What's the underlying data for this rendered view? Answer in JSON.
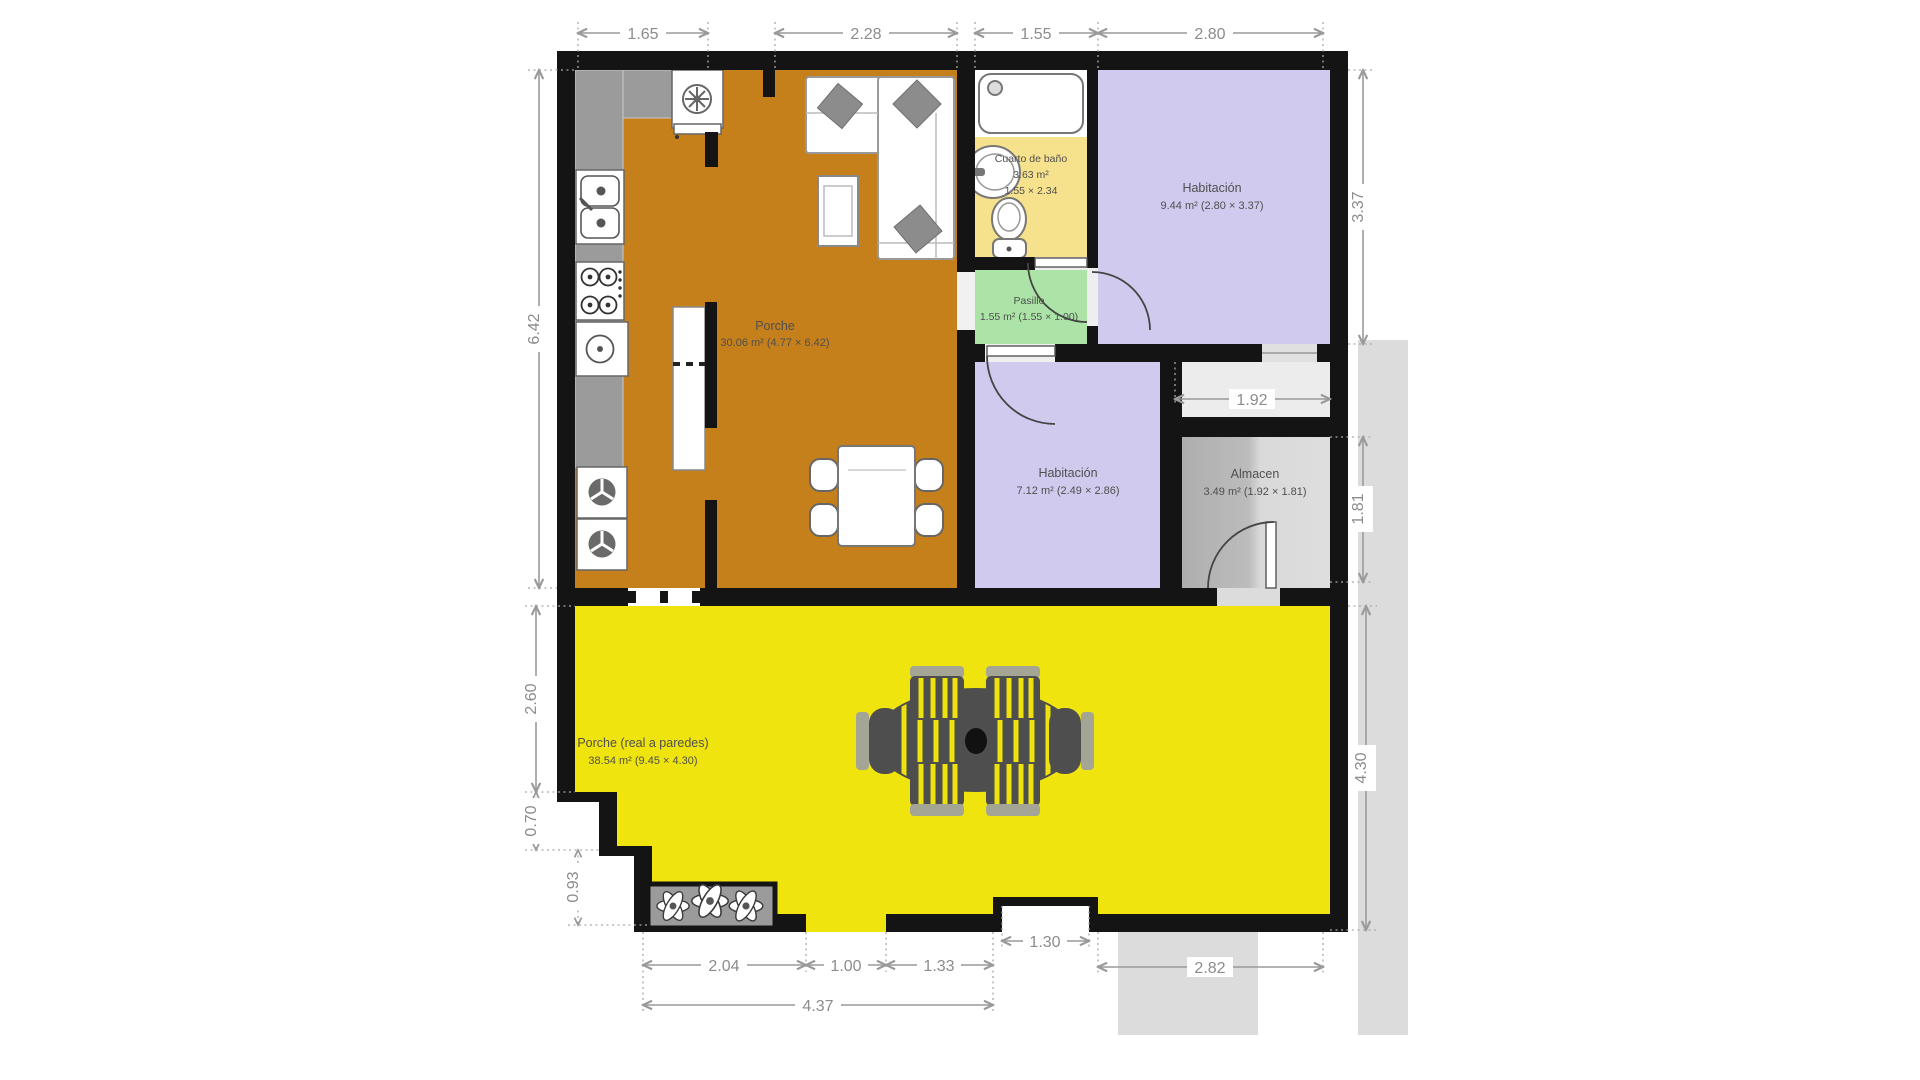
{
  "plan": {
    "title": "floor-plan",
    "rooms": {
      "porche": {
        "name": "Porche",
        "area": "30.06 m² (4.77 × 6.42)"
      },
      "bano": {
        "name": "Cuarto de baño",
        "area": "3.63 m²",
        "size": "1.55 × 2.34"
      },
      "habitacion1": {
        "name": "Habitación",
        "area": "9.44 m² (2.80 × 3.37)"
      },
      "pasillo": {
        "name": "Pasillo",
        "area": "1.55 m² (1.55 × 1.00)"
      },
      "habitacion2": {
        "name": "Habitación",
        "area": "7.12 m² (2.49 × 2.86)"
      },
      "almacen": {
        "name": "Almacen",
        "area": "3.49 m² (1.92 × 1.81)"
      },
      "porche_exterior": {
        "name": "Porche (real a paredes)",
        "area": "38.54 m² (9.45 × 4.30)"
      }
    },
    "dims": {
      "top": [
        "1.65",
        "2.28",
        "1.55",
        "2.80"
      ],
      "left": [
        "6.42",
        "2.60",
        "0.70",
        "0.93"
      ],
      "right": [
        "3.37",
        "1.92",
        "1.81",
        "4.30"
      ],
      "bottom": [
        "2.04",
        "1.00",
        "1.33",
        "1.30",
        "2.82",
        "4.37"
      ]
    },
    "colors": {
      "wall": "#141414",
      "living_orange": "#c57f1b",
      "patio_yellow": "#f0e40f",
      "bedroom_purple": "#d0cbee",
      "bath_yellow": "#f6e18c",
      "hall_green": "#abe4a6",
      "storage_gray": "#c4c4c4",
      "dim_gray": "#8c8c8c"
    }
  }
}
